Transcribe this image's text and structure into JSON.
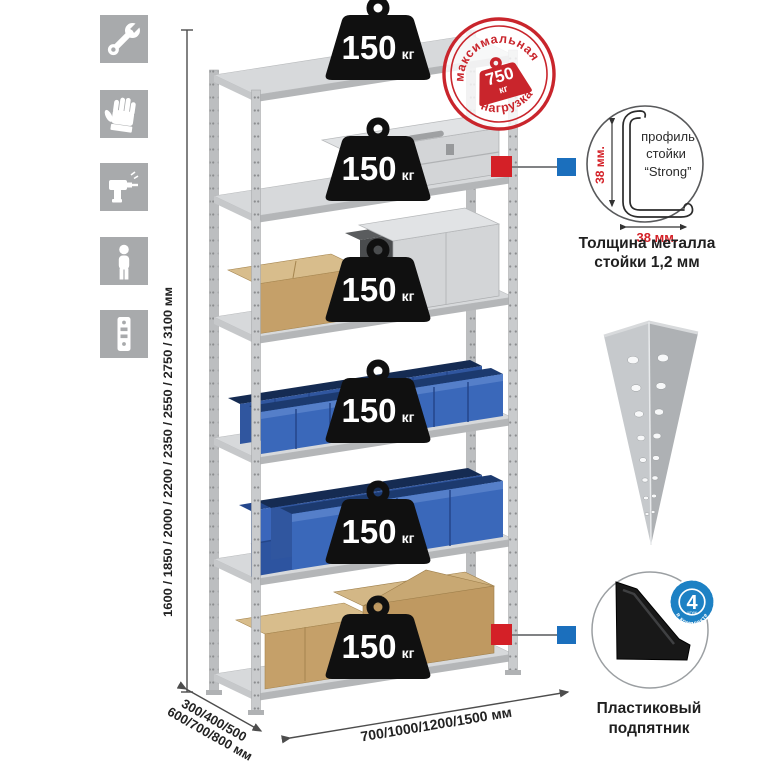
{
  "left_toolbar": {
    "icons": [
      {
        "name": "wrench"
      },
      {
        "name": "gloves"
      },
      {
        "name": "drill"
      },
      {
        "name": "person"
      },
      {
        "name": "upright-post"
      }
    ]
  },
  "dimensions": {
    "height": "1600 / 1850 / 2000 / 2200 / 2350 / 2550 / 2750 / 3100 мм",
    "depth_line1": "300/400/500",
    "depth_line2": "600/700/800 мм",
    "width": "700/1000/1200/1500 мм"
  },
  "max_load_stamp": {
    "arc_top": "максимальная",
    "arc_bottom": "нагрузка",
    "value": "750",
    "unit": "кг"
  },
  "shelf_load_badges": [
    {
      "value": "150",
      "unit": "кг"
    },
    {
      "value": "150",
      "unit": "кг"
    },
    {
      "value": "150",
      "unit": "кг"
    },
    {
      "value": "150",
      "unit": "кг"
    },
    {
      "value": "150",
      "unit": "кг"
    },
    {
      "value": "150",
      "unit": "кг"
    }
  ],
  "profile_detail": {
    "label_1": "профиль",
    "label_2": "стойки",
    "label_3": "“Strong”",
    "dim_vertical": "38 мм.",
    "dim_horizontal": "38 мм.",
    "caption_1": "Толщина металла",
    "caption_2": "стойки 1,2 мм"
  },
  "foot_detail": {
    "badge_value": "4",
    "badge_sub": "штуки",
    "badge_arc": "в комплекте",
    "caption_1": "Пластиковый",
    "caption_2": "подпятник"
  },
  "colors": {
    "accent_red": "#d42027",
    "accent_blue": "#1b6fbd",
    "stamp_red": "#c9252c",
    "badge_black": "#101010",
    "icon_gray": "#a8aaac",
    "bin_blue": "#3a68ba"
  }
}
